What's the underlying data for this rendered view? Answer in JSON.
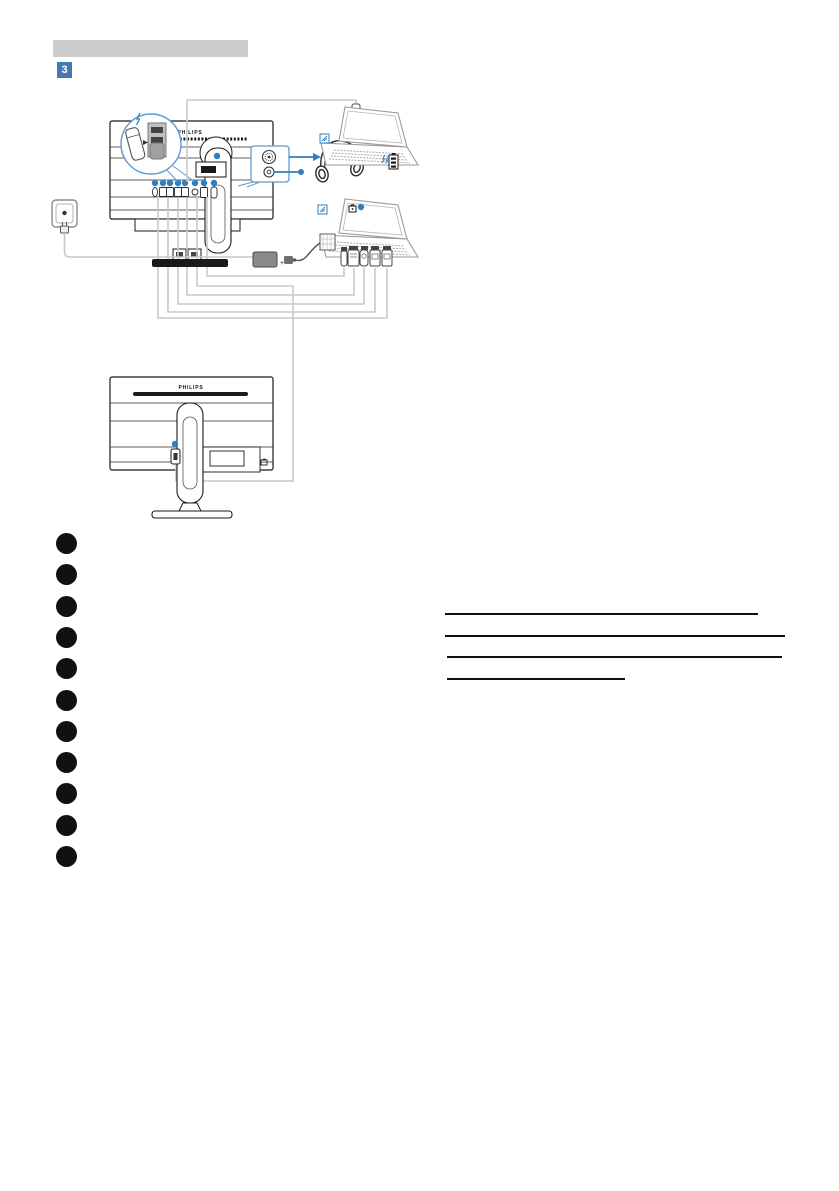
{
  "page": {
    "section_badge": "3"
  },
  "header": {
    "bar_color": "#cccccc"
  },
  "diagram": {
    "brand": "PHILIPS",
    "adapter_plus": "+",
    "accent_blue": "#2e7fc2",
    "callout_blue": "#5b9bd5",
    "cable_gray": "#c9c9c9",
    "port_dots_top_monitor": 8,
    "port_dots_bottom_monitor": 1,
    "icons": [
      {
        "name": "usb-stick-icon"
      },
      {
        "name": "fast-charge-lightning-icon"
      },
      {
        "name": "usb-port-magnifier-icon"
      },
      {
        "name": "audio-jacks-icon"
      },
      {
        "name": "headphones-icon"
      },
      {
        "name": "usb-c-plug-icon"
      },
      {
        "name": "laptop-icon"
      },
      {
        "name": "battery-charging-icon"
      },
      {
        "name": "kensington-lock-icon"
      },
      {
        "name": "power-outlet-icon"
      },
      {
        "name": "power-adapter-icon"
      },
      {
        "name": "video-connector-icons"
      },
      {
        "name": "daisy-chain-monitor-icon"
      }
    ]
  },
  "connection_list": {
    "marker_count": 11,
    "marker_color": "#111111"
  },
  "links": {
    "underline_count": 4
  }
}
